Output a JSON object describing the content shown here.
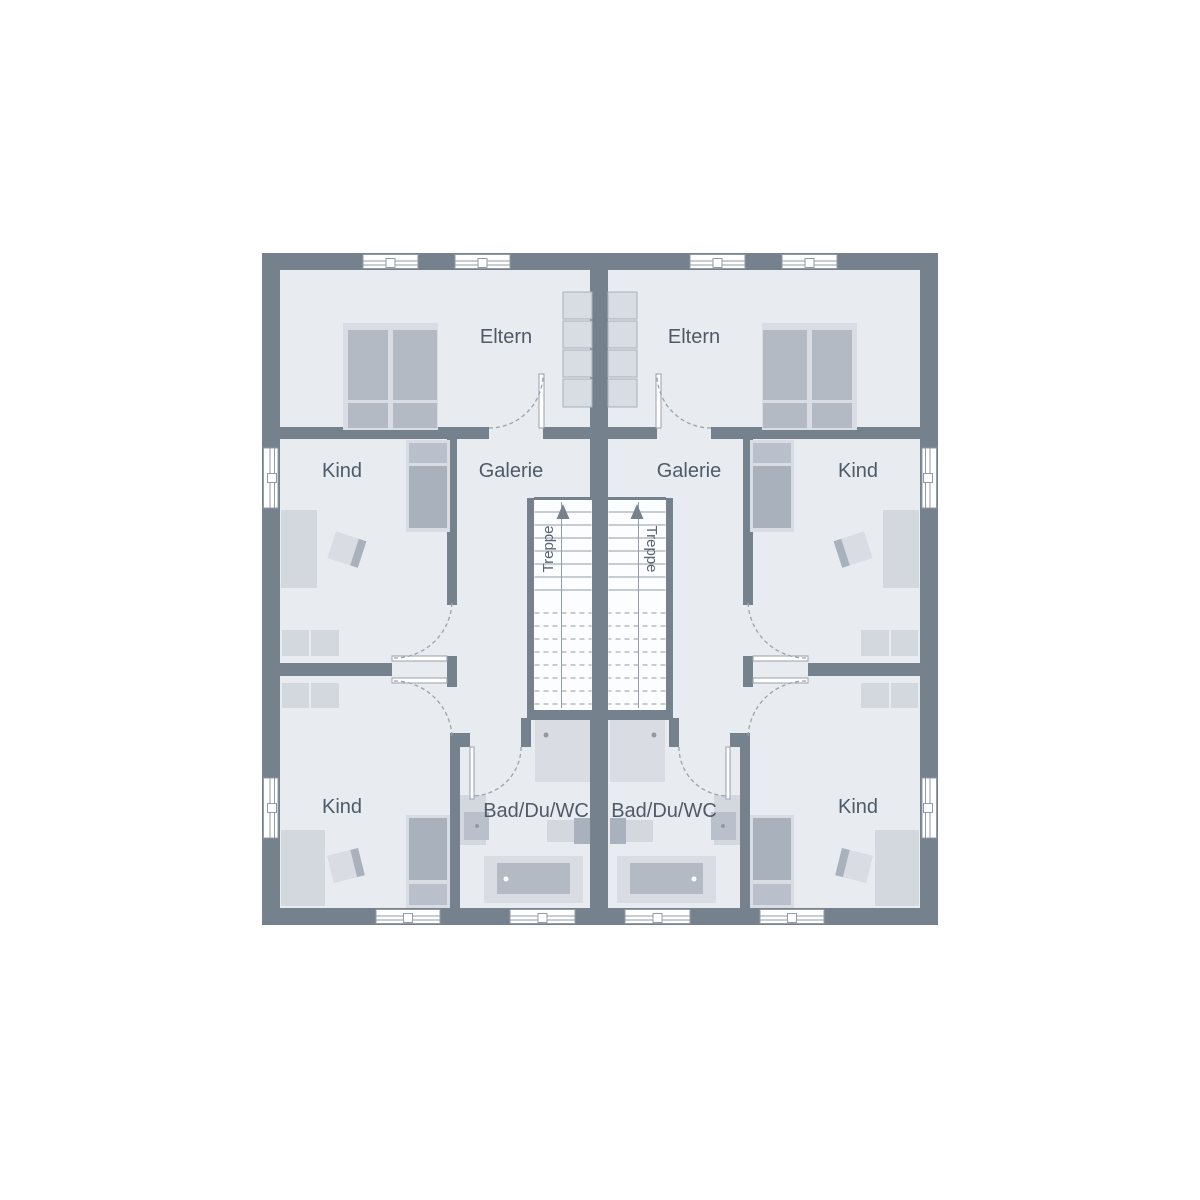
{
  "units": {
    "left": {
      "eltern_label": "Eltern",
      "galerie_label": "Galerie",
      "kind_upper_label": "Kind",
      "kind_lower_label": "Kind",
      "bad_label": "Bad/Du/WC",
      "treppe_label": "Treppe"
    },
    "right": {
      "eltern_label": "Eltern",
      "galerie_label": "Galerie",
      "kind_upper_label": "Kind",
      "kind_lower_label": "Kind",
      "bad_label": "Bad/Du/WC",
      "treppe_label": "Treppe"
    }
  },
  "icons": {
    "stair_direction": "arrow-up-icon"
  },
  "colors": {
    "background": "#ffffff",
    "wall": "#76818e",
    "floor": "#e8ebf0",
    "stair_fill": "#fcfdfe",
    "detail_line": "#929ba8",
    "furniture_light": "#d9dce2",
    "furniture_medium": "#b9c0cb",
    "furniture_dark": "#a9b1bd",
    "label_text": "#4f5a68"
  }
}
